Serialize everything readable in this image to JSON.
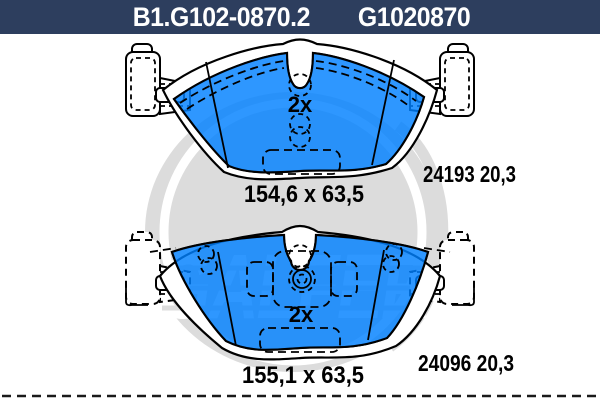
{
  "header": {
    "code_left": "B1.G102-0870.2",
    "code_right": "G1020870"
  },
  "pads": {
    "top": {
      "quantity": "2x",
      "dimensions": "154,6 x 63,5",
      "ref": "24193 20,3"
    },
    "bottom": {
      "quantity": "2x",
      "dimensions": "155,1 x 63,5",
      "ref": "24096 20,3"
    }
  },
  "watermark": {
    "brand": "GALFER"
  },
  "colors": {
    "header_bg": "#2d3e5e",
    "pad_blue": "#0080ff",
    "watermark_gray": "#dcdcdc",
    "outline": "#000000"
  }
}
